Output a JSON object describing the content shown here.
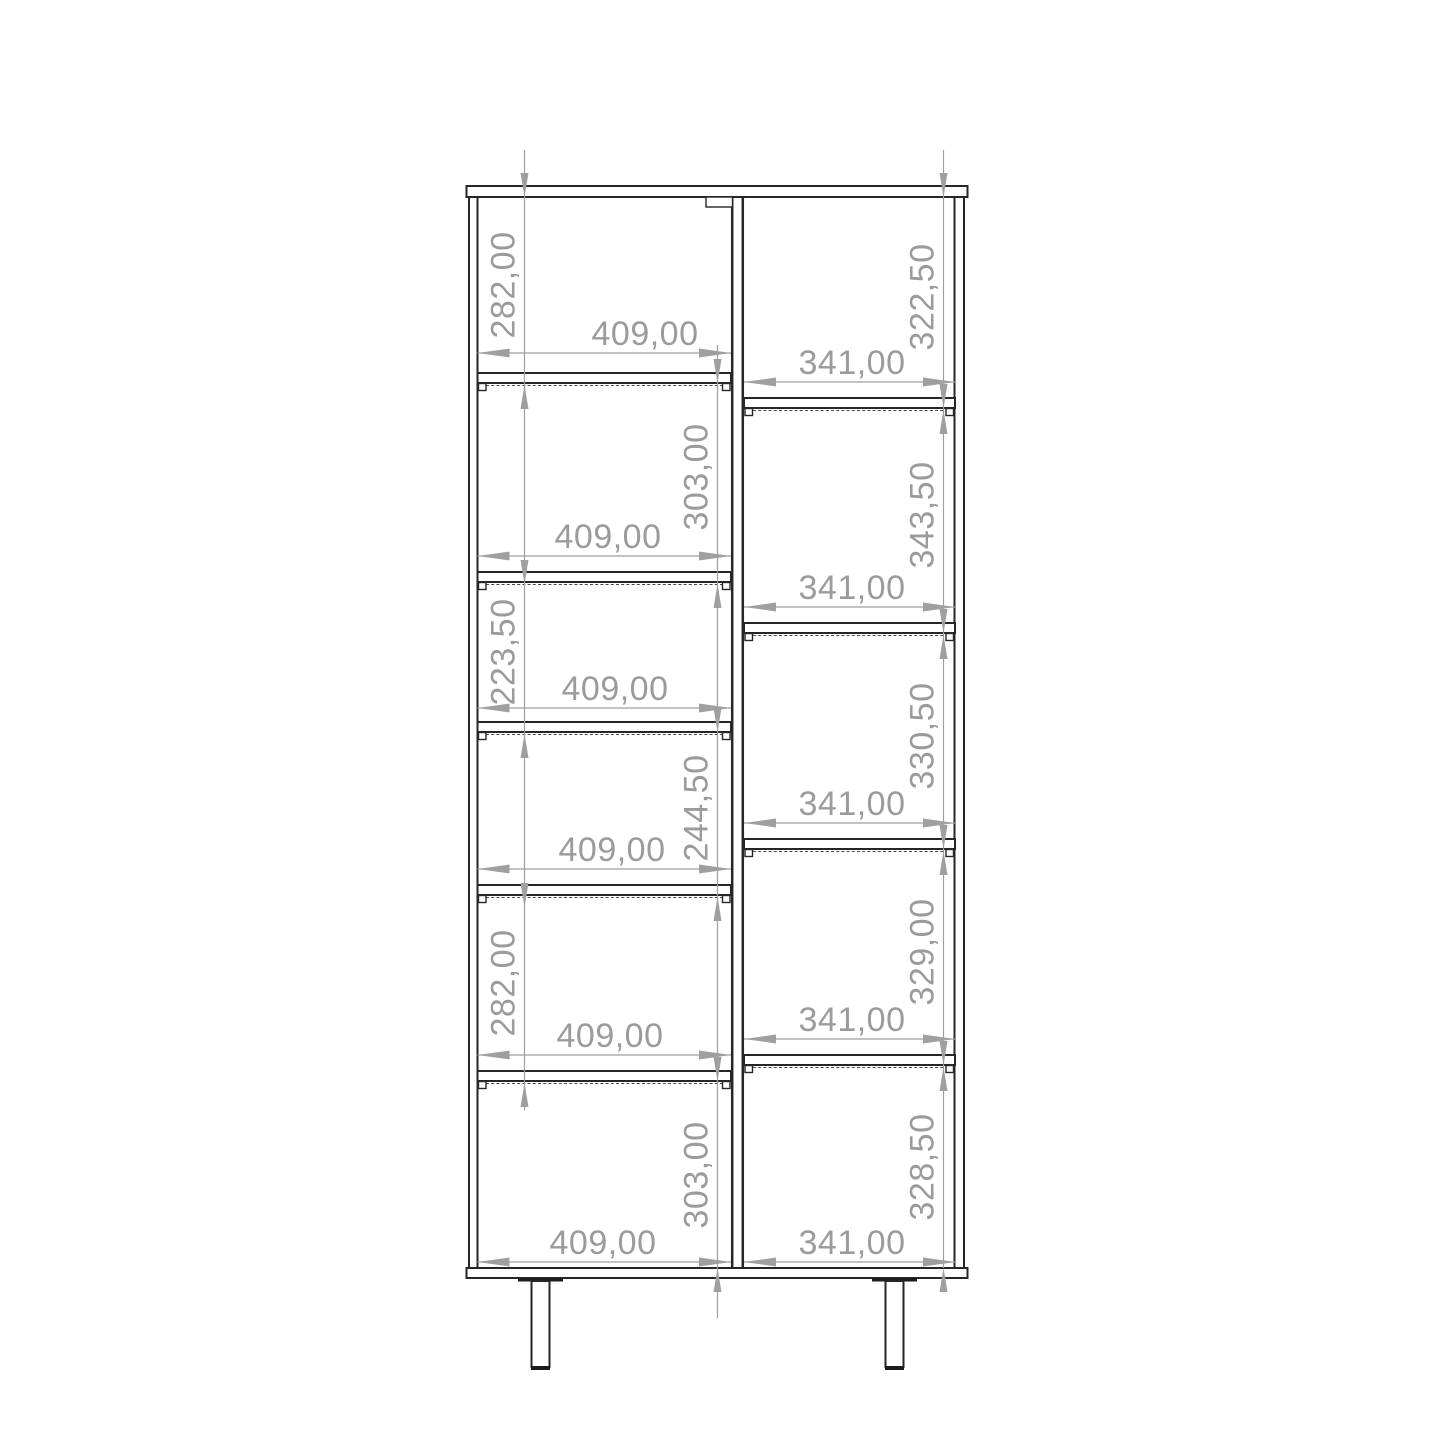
{
  "drawing": {
    "colors": {
      "outline": "#262626",
      "dimension": "#9b9b9b",
      "background": "#ffffff"
    },
    "left_column": {
      "cells": [
        {
          "height": "282,00",
          "width": "409,00"
        },
        {
          "height": "303,00",
          "width": "409,00"
        },
        {
          "height": "223,50",
          "width": "409,00"
        },
        {
          "height": "244,50",
          "width": "409,00"
        },
        {
          "height": "282,00",
          "width": "409,00"
        },
        {
          "height": "303,00",
          "width": "409,00"
        }
      ]
    },
    "right_column": {
      "cells": [
        {
          "height": "322,50",
          "width": "341,00"
        },
        {
          "height": "343,50",
          "width": "341,00"
        },
        {
          "height": "330,50",
          "width": "341,00"
        },
        {
          "height": "329,00",
          "width": "341,00"
        },
        {
          "height": "328,50",
          "width": "341,00"
        }
      ]
    }
  }
}
